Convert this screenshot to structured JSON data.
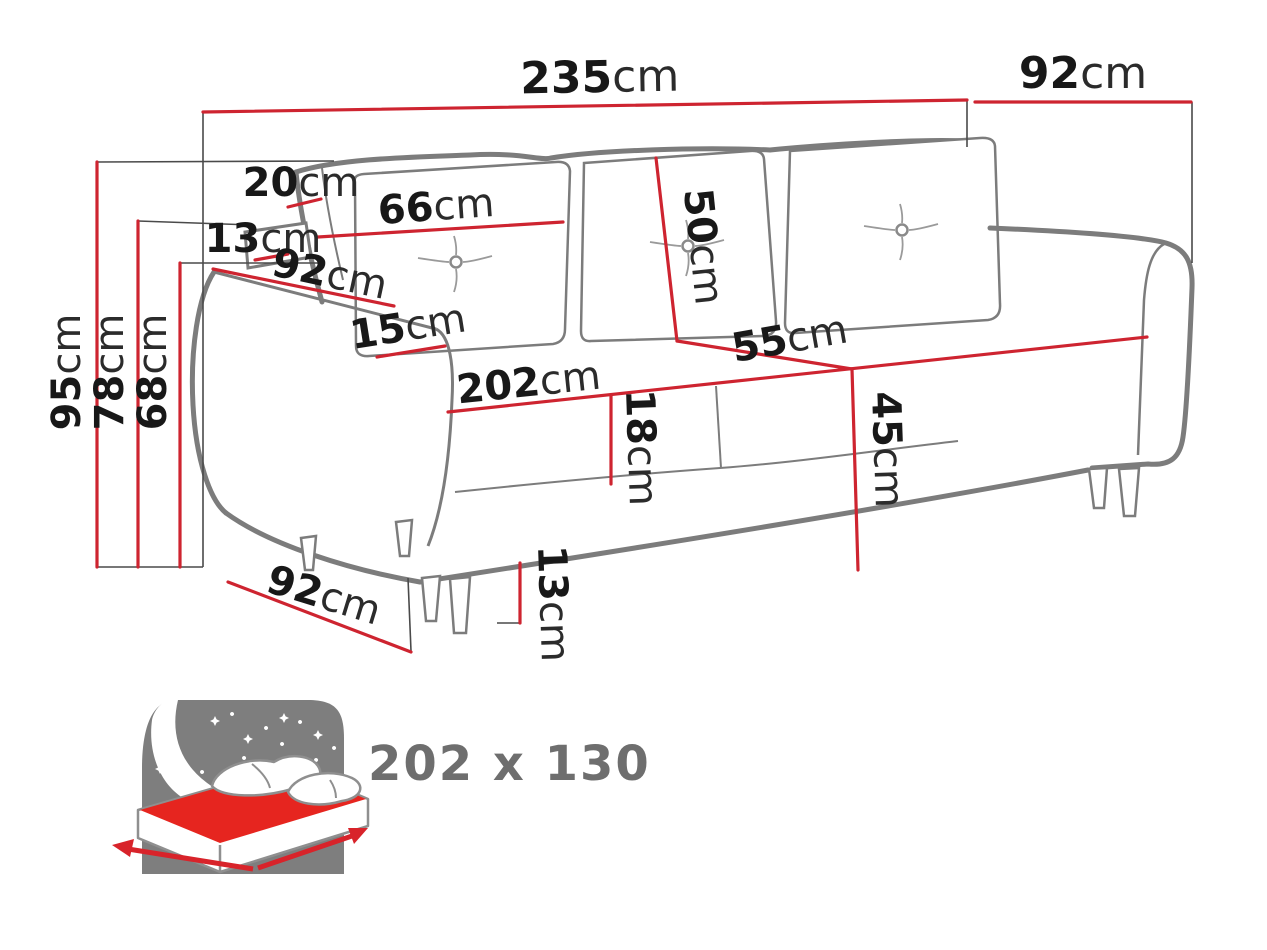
{
  "diagram": {
    "type": "sofa-dimension-diagram",
    "subject": "three-seat sofa bed line drawing with red dimension annotations",
    "units": "cm",
    "colors": {
      "dimension_red": "#ce2430",
      "outline_gray": "#7c7c7c",
      "extension_black": "#4a4a4a",
      "text_black": "#181818",
      "icon_panel_gray": "#7e7e7e",
      "mattress_red": "#e6251f",
      "sleep_text_gray": "#6e6e6e"
    },
    "dimensions": {
      "overall_width": {
        "value": "235",
        "unit": "cm"
      },
      "overall_depth": {
        "value": "92",
        "unit": "cm"
      },
      "back_cushion_thickness": {
        "value": "20",
        "unit": "cm"
      },
      "headrest_panel_thickness": {
        "value": "13",
        "unit": "cm"
      },
      "back_cushion_width": {
        "value": "66",
        "unit": "cm"
      },
      "back_cushion_height": {
        "value": "50",
        "unit": "cm"
      },
      "armrest_length": {
        "value": "92",
        "unit": "cm"
      },
      "armrest_width": {
        "value": "15",
        "unit": "cm"
      },
      "seat_width": {
        "value": "202",
        "unit": "cm"
      },
      "seat_cushion_thickness": {
        "value": "18",
        "unit": "cm"
      },
      "seat_depth": {
        "value": "55",
        "unit": "cm"
      },
      "seat_height": {
        "value": "45",
        "unit": "cm"
      },
      "total_height": {
        "value": "95",
        "unit": "cm"
      },
      "backrest_height": {
        "value": "78",
        "unit": "cm"
      },
      "armrest_height": {
        "value": "68",
        "unit": "cm"
      },
      "base_depth": {
        "value": "92",
        "unit": "cm"
      },
      "leg_height": {
        "value": "13",
        "unit": "cm"
      }
    },
    "sleeping_area": {
      "label": "202 x 130"
    }
  }
}
